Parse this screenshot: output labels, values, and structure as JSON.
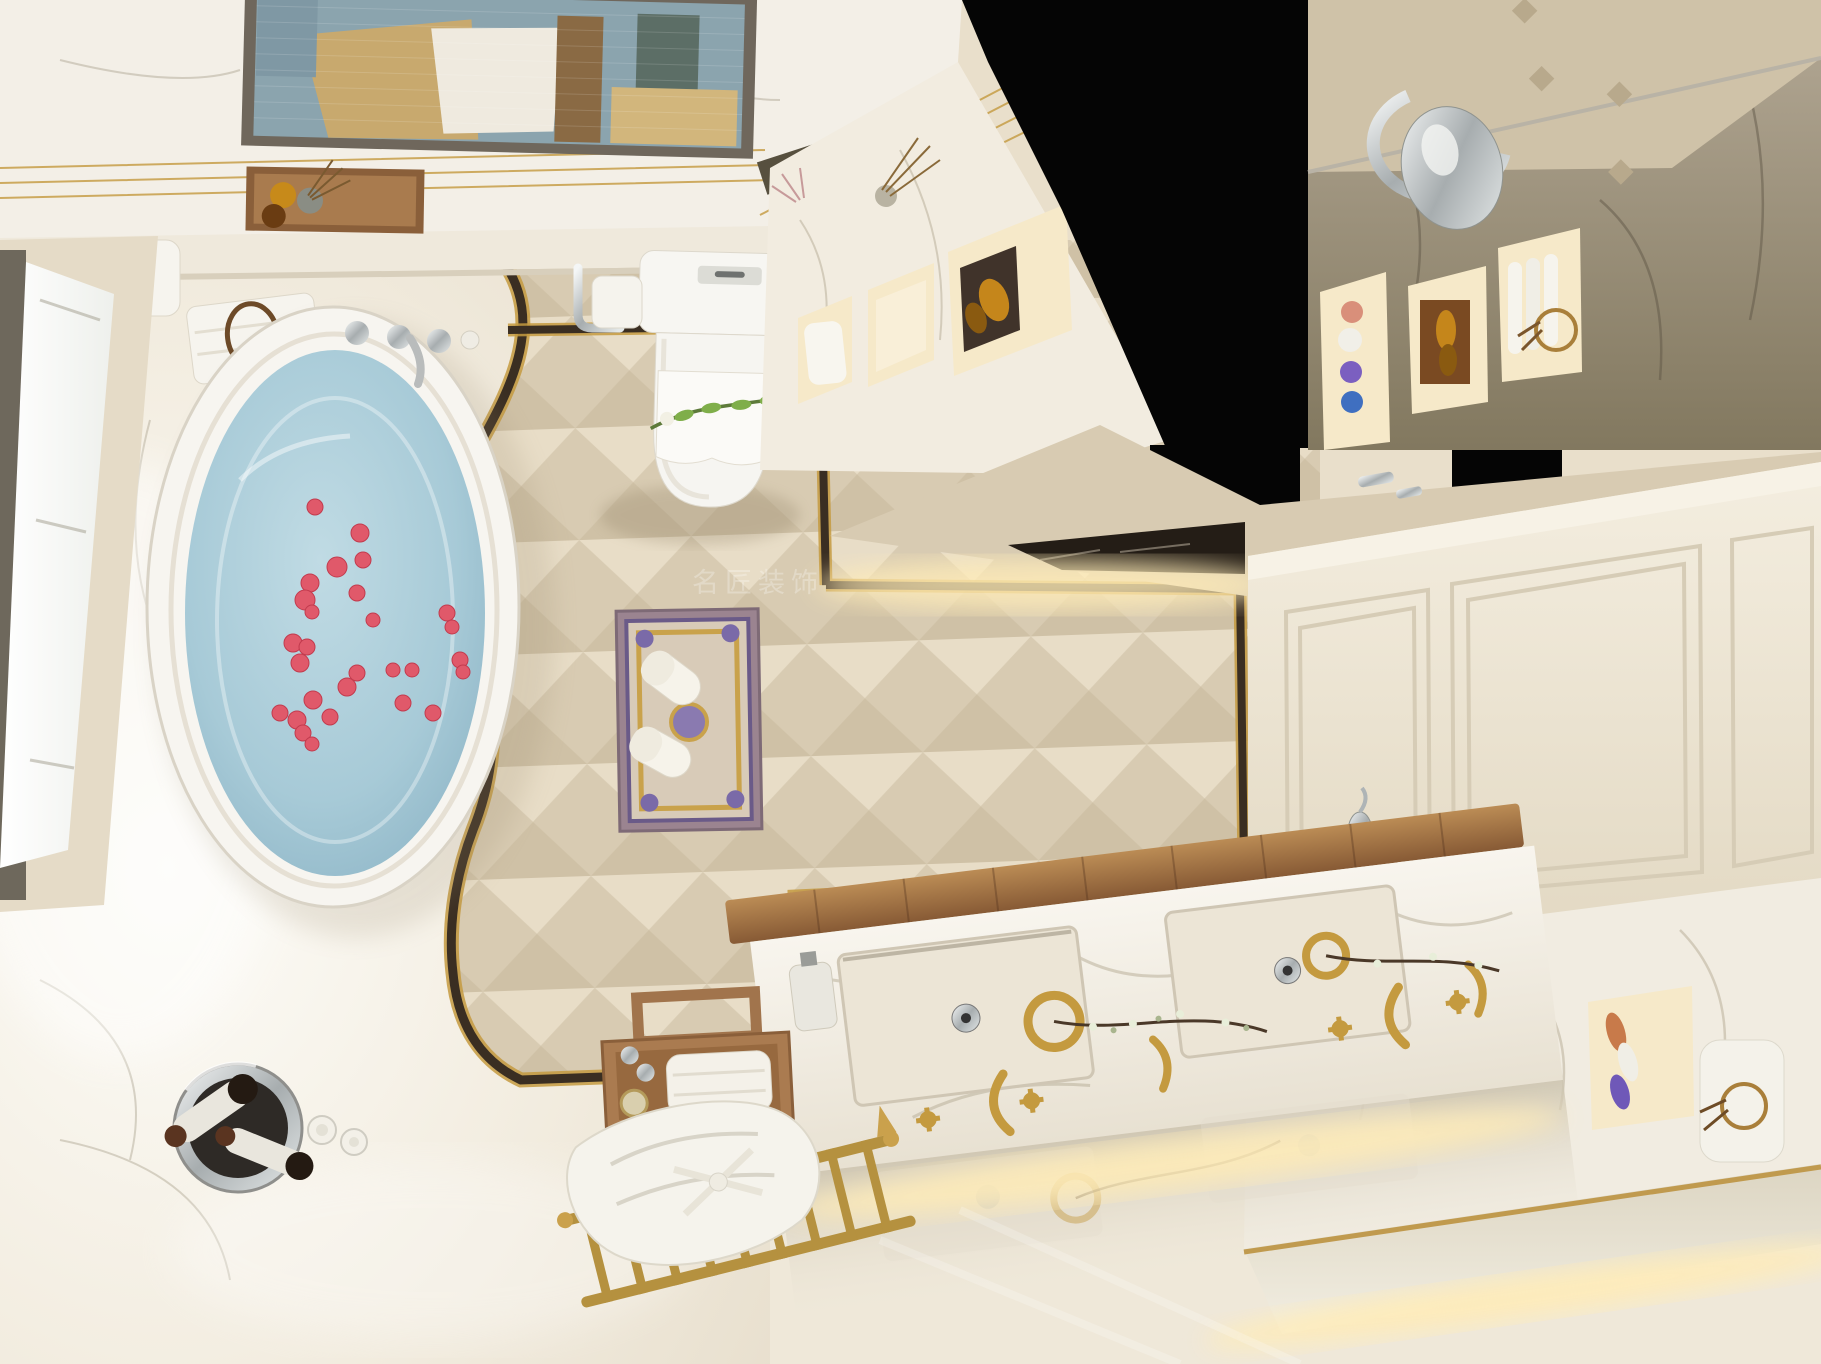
{
  "meta": {
    "description": "Top-down 3D rendering of a luxury neoclassical bathroom with freestanding tub, rose petals, double vanity and lit wall niches"
  },
  "watermark": {
    "text": "名匠装饰"
  },
  "palette": {
    "ceiling_white": "#f3efe7",
    "wall_cream": "#e9dfcb",
    "tile_base": "#ddd1b9",
    "tile_light": "#e8ddc7",
    "tile_mid": "#d8cbb2",
    "tile_dark": "#cfc1a6",
    "inlay_dark": "#3a2e22",
    "gold": "#c49a3f",
    "brass": "#b5913f",
    "walnut": "#9a6c44",
    "water_blue": "#a9cbd8",
    "petal_red": "#e0596a",
    "marble_floor": "#f6f3ec",
    "gray_marble": "#a59b89",
    "niche_glow": "#f6e9c9",
    "led_glow": "#ffecb8",
    "chrome": "#cdd0d0",
    "door_cream": "#efe8d9",
    "black_void": "#050505",
    "art_blue": "#8ba4ae",
    "art_tan": "#c8a96e"
  },
  "objects": [
    "ceiling-artwork",
    "gold-ceiling-trim",
    "amenity-tray",
    "rolled-towels",
    "freestanding-bathtub",
    "rose-petals",
    "tub-faucet",
    "window-bay",
    "toilet",
    "toilet-paper-holder",
    "toilet-brush",
    "wall-niche-shelves",
    "ornamental-rug",
    "slippers",
    "floor-border-inlay",
    "diamond-tile-floor",
    "champagne-bucket",
    "wine-glasses",
    "wooden-stool-with-towels",
    "brass-rack-with-bathrobe",
    "double-sink-vanity",
    "gold-cross-taps",
    "flower-branches",
    "mirror-wall-niches",
    "led-cove-lighting",
    "paneled-door",
    "vanity-wall-lamp",
    "perfume-bottles",
    "black-ceiling-void"
  ],
  "petals": [
    {
      "x": 315,
      "y": 507,
      "r": 8
    },
    {
      "x": 360,
      "y": 533,
      "r": 9
    },
    {
      "x": 363,
      "y": 560,
      "r": 8
    },
    {
      "x": 337,
      "y": 567,
      "r": 10
    },
    {
      "x": 357,
      "y": 593,
      "r": 8
    },
    {
      "x": 310,
      "y": 583,
      "r": 9
    },
    {
      "x": 305,
      "y": 600,
      "r": 10
    },
    {
      "x": 312,
      "y": 612,
      "r": 7
    },
    {
      "x": 447,
      "y": 613,
      "r": 8
    },
    {
      "x": 452,
      "y": 627,
      "r": 7
    },
    {
      "x": 373,
      "y": 620,
      "r": 7
    },
    {
      "x": 293,
      "y": 643,
      "r": 9
    },
    {
      "x": 307,
      "y": 647,
      "r": 8
    },
    {
      "x": 300,
      "y": 663,
      "r": 9
    },
    {
      "x": 357,
      "y": 673,
      "r": 8
    },
    {
      "x": 347,
      "y": 687,
      "r": 9
    },
    {
      "x": 393,
      "y": 670,
      "r": 7
    },
    {
      "x": 412,
      "y": 670,
      "r": 7
    },
    {
      "x": 460,
      "y": 660,
      "r": 8
    },
    {
      "x": 463,
      "y": 672,
      "r": 7
    },
    {
      "x": 313,
      "y": 700,
      "r": 9
    },
    {
      "x": 280,
      "y": 713,
      "r": 8
    },
    {
      "x": 297,
      "y": 720,
      "r": 9
    },
    {
      "x": 330,
      "y": 717,
      "r": 8
    },
    {
      "x": 403,
      "y": 703,
      "r": 8
    },
    {
      "x": 433,
      "y": 713,
      "r": 8
    },
    {
      "x": 303,
      "y": 733,
      "r": 8
    },
    {
      "x": 312,
      "y": 744,
      "r": 7
    }
  ]
}
